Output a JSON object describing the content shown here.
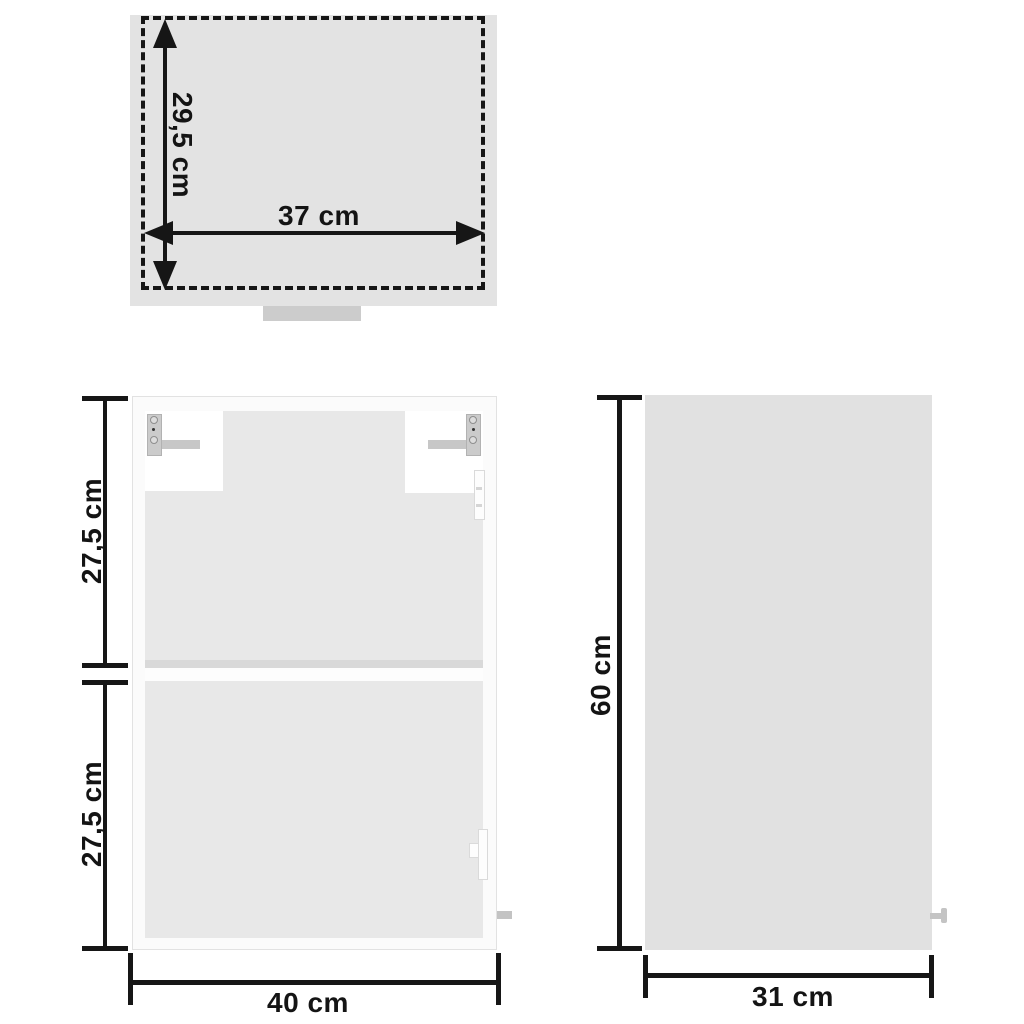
{
  "top_view": {
    "height_label": "29,5 cm",
    "width_label": "37 cm"
  },
  "front_view": {
    "upper_height_label": "27,5 cm",
    "lower_height_label": "27,5 cm",
    "width_label": "40 cm"
  },
  "side_view": {
    "height_label": "60 cm",
    "depth_label": "31 cm"
  },
  "dimensions_cm": {
    "top_view_depth": 29.5,
    "top_view_width": 37,
    "front_upper_section_height": 27.5,
    "front_lower_section_height": 27.5,
    "front_width": 40,
    "side_height": 60,
    "side_depth": 31
  },
  "colors": {
    "line_ink": "#161616",
    "top_view_body": "#e3e3e3",
    "cabinet_interior": "#e8e8e8",
    "side_panel": "#e1e1e1",
    "hardware_gray": "#c7c7c7",
    "background": "#ffffff"
  }
}
